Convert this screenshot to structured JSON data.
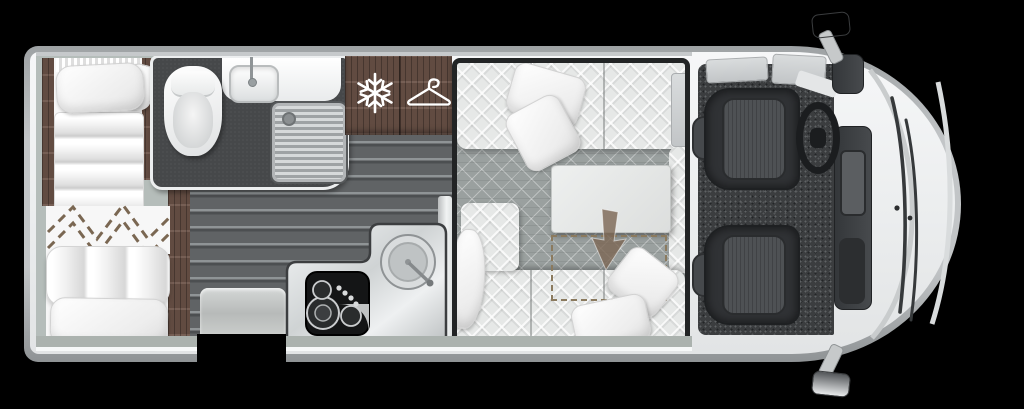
{
  "meta": {
    "title": "Campervan top-view floor plan",
    "visible_text": "none"
  },
  "icons": {
    "fridge": {
      "name": "snowflake-icon",
      "meaning": "fridge-freezer"
    },
    "wardrobe": {
      "name": "hanger-icon",
      "meaning": "wardrobe"
    },
    "dropbed": {
      "name": "drop-down-bed-arrow-icon",
      "meaning": "drop-down bed lowers over lounge"
    }
  },
  "colors": {
    "background": "#000000",
    "body_edge": "#b9bcbe",
    "body_white": "#f2f4f5",
    "wood_cabinet": "#6e554a",
    "floor_planks": "#5d6062",
    "bathroom_floor": "#46484a",
    "bed_platform": "#b5bdba",
    "lounge_carpet": "#9aa09f",
    "sofa_quilt": "#e6e8e7",
    "cab_carpet": "#3b3d3f",
    "seat": "#303235",
    "counter_steel": "#dfe2e3",
    "hob": "#161718",
    "dashed_bed_outline": "#8b7a5e",
    "interior_band": "#abb2ae"
  },
  "areas": {
    "rear_beds": "twin transverse beds",
    "bathroom": "toilet, washbasin, shower",
    "storage": "fridge and wardrobe cabinet",
    "kitchen": "hob and round sink",
    "lounge": "L-sofa with table and drop-down bed zone",
    "cab": "driver and passenger swivel seats"
  }
}
